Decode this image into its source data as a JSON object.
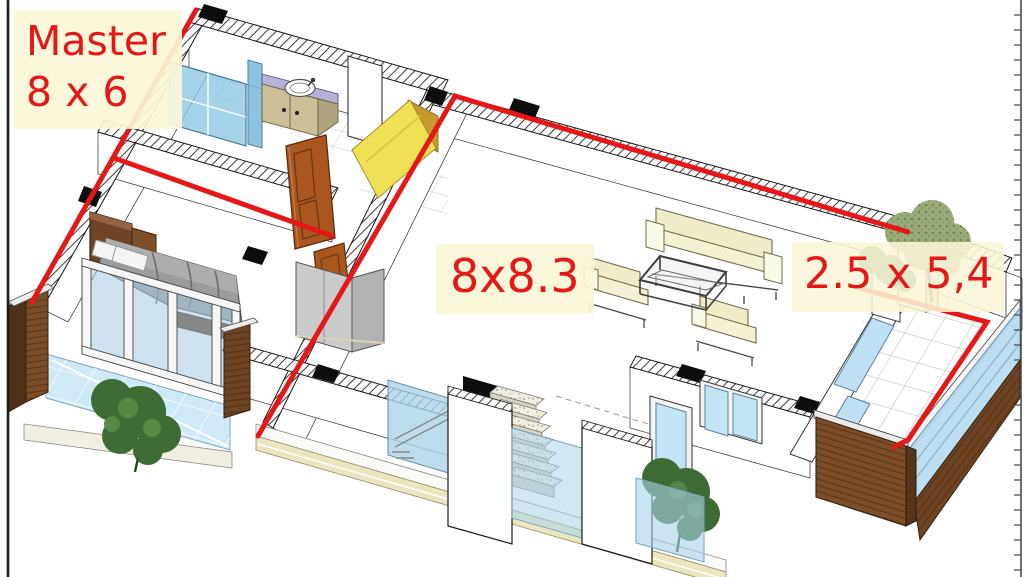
{
  "scene": {
    "type": "3d-axonometric-floorplan-render",
    "background": "#ffffff"
  },
  "annotations": {
    "accent_red": "#e51717",
    "label_background": "#faf6d8",
    "master_label": {
      "line1": "Master",
      "line2": "8 x 6"
    },
    "living_label": {
      "text": "8x8.3"
    },
    "terrace_label": {
      "text": "2.5 x 5,4"
    }
  },
  "palette": {
    "glass_blue": "#c5e3f2",
    "shower_blue": "#8cc6e2",
    "wood_brown": "#7d4e28",
    "door_brown": "#a9571f",
    "closet_yellow": "#f0e056",
    "vanity_lavender": "#b6b2d6",
    "sofa_cream": "#f0ebc8",
    "facade_cream": "#ebe6bf",
    "bed_gray": "#9c9c9c",
    "plant_green": "#3f6b35",
    "terrace_tree_green": "#9aab79"
  }
}
